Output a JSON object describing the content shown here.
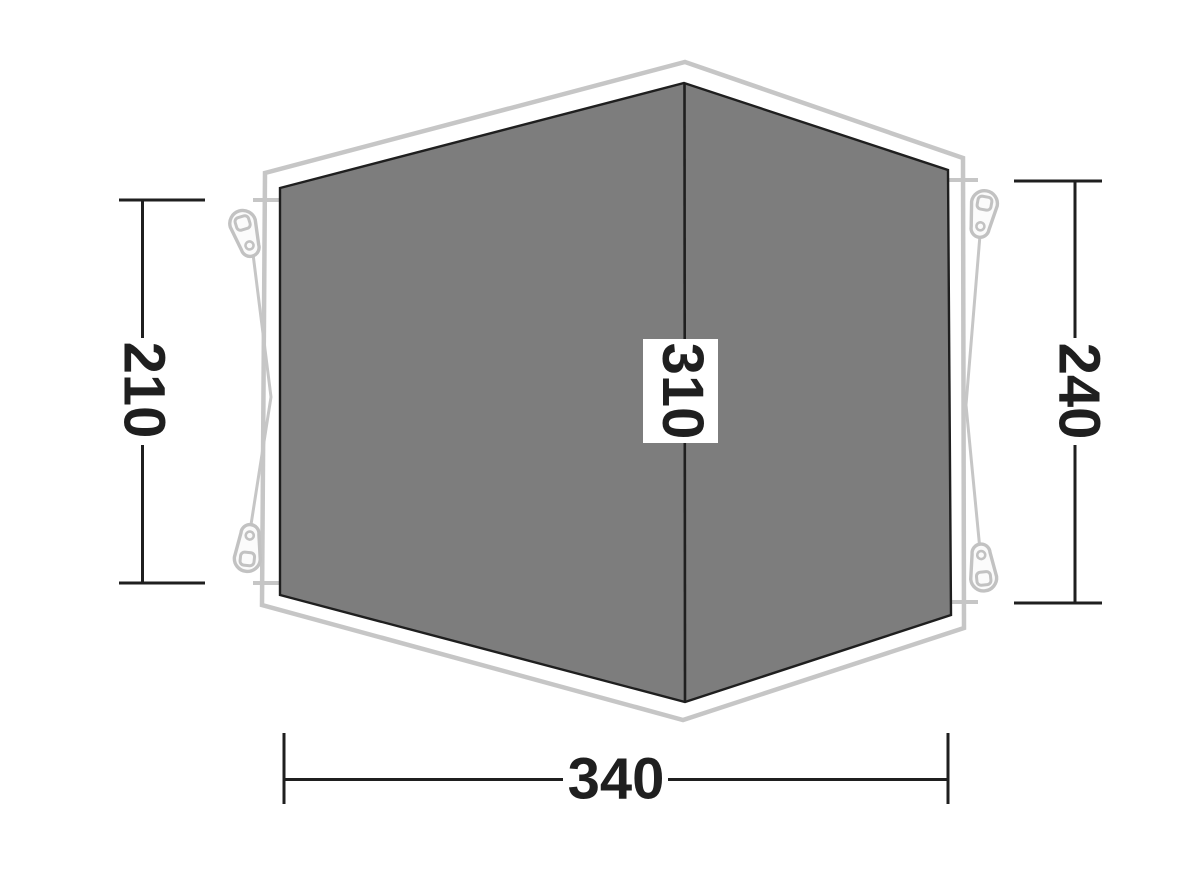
{
  "diagram": {
    "name": "tent-footprint-top-view",
    "dimensions": {
      "left_side": {
        "value": "210"
      },
      "ridge": {
        "value": "310"
      },
      "right_side": {
        "value": "240"
      },
      "front_width": {
        "value": "340"
      }
    },
    "colors": {
      "background": "#ffffff",
      "floor_fill": "#7d7d7d",
      "floor_edge": "#1f1f1f",
      "outline": "#c6c6c6",
      "peg_fill": "#fbfbfb",
      "peg_stroke": "#c2c2c2",
      "dimension": "#1f1f1f",
      "label_box": "#ffffff"
    }
  }
}
